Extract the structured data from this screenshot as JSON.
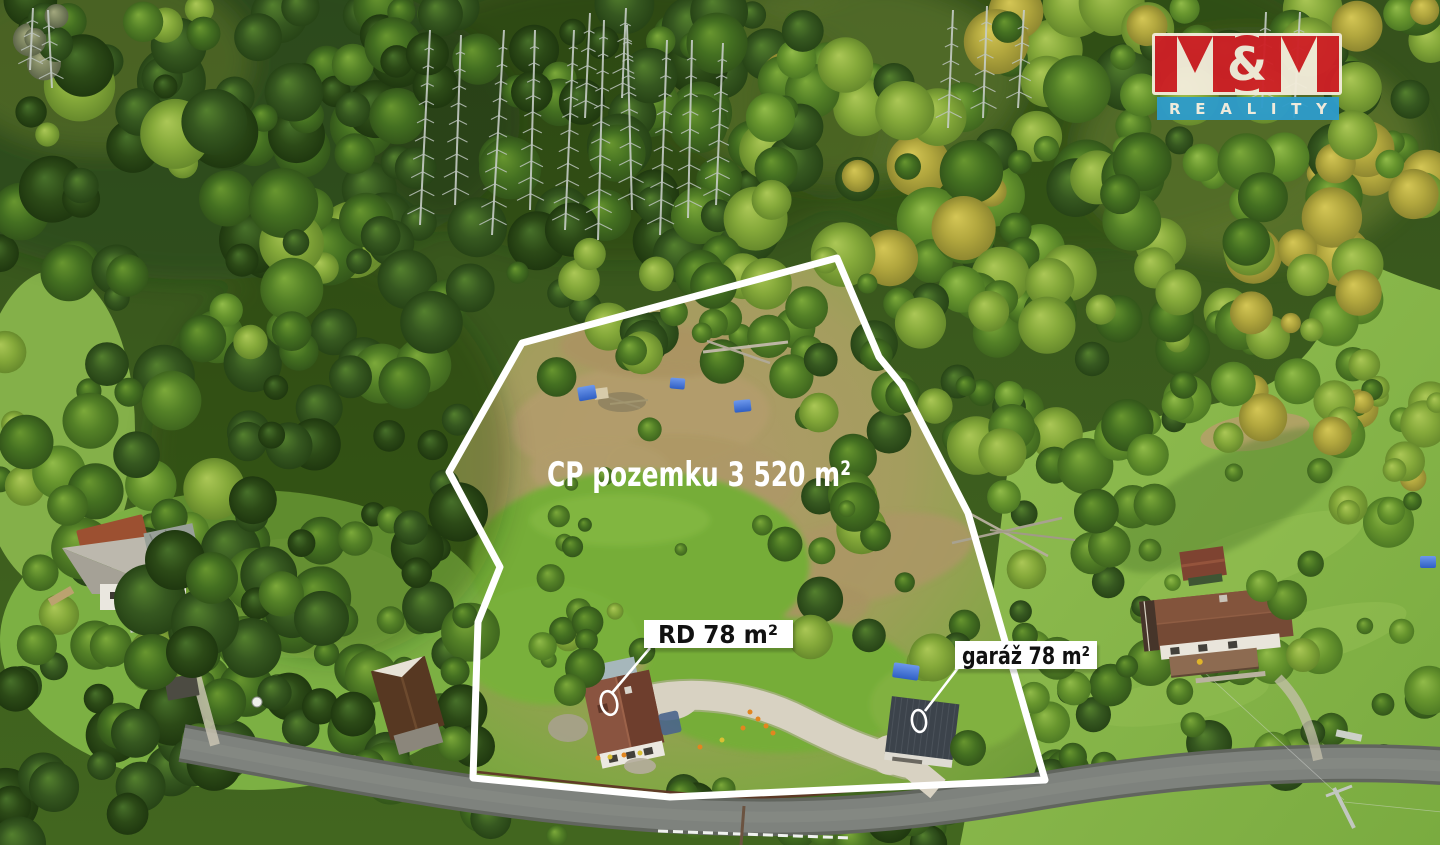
{
  "annotations": {
    "area_label": {
      "text": "CP pozemku 3 520 m²",
      "tx": 699,
      "ty": 486,
      "color": "#ffffff"
    },
    "house_label": {
      "text": "RD 78 m²",
      "box": {
        "x": 644,
        "y": 620,
        "w": 149,
        "h": 28
      },
      "tx": 718,
      "ty": 643
    },
    "garage_label": {
      "text": "garáž 78 m²",
      "box": {
        "x": 955,
        "y": 641,
        "w": 142,
        "h": 28
      },
      "tx": 1026,
      "ty": 664
    },
    "boundary": {
      "points": "837,258 879,357 902,385 968,513 1045,780 670,797 473,778 478,622 500,567 449,472 522,343",
      "color": "#ffffff",
      "width": 7
    },
    "house_leader": {
      "d": "M 650,648 L 612,693"
    },
    "garage_leader": {
      "d": "M 958,668 L 925,711"
    },
    "house_marker": {
      "cx": 609,
      "cy": 703,
      "rx": 8,
      "ry": 12,
      "transform": "rotate(-14 609 703)"
    },
    "garage_marker": {
      "cx": 919,
      "cy": 721,
      "rx": 7,
      "ry": 11,
      "transform": "rotate(-8 919 721)"
    }
  },
  "logo": {
    "mm": "M&M",
    "amp": "&",
    "reality": "REALITY",
    "red": "#ce2026",
    "blue": "#2e9cca",
    "cream": "#f2ecda"
  },
  "colors": {
    "boundary_white": "#ffffff",
    "label_bg": "#ffffff",
    "label_text": "#111111",
    "tarp_blue": "#3568cd",
    "road_gray": "#7e827d",
    "gravel": "#d8d2c2"
  }
}
